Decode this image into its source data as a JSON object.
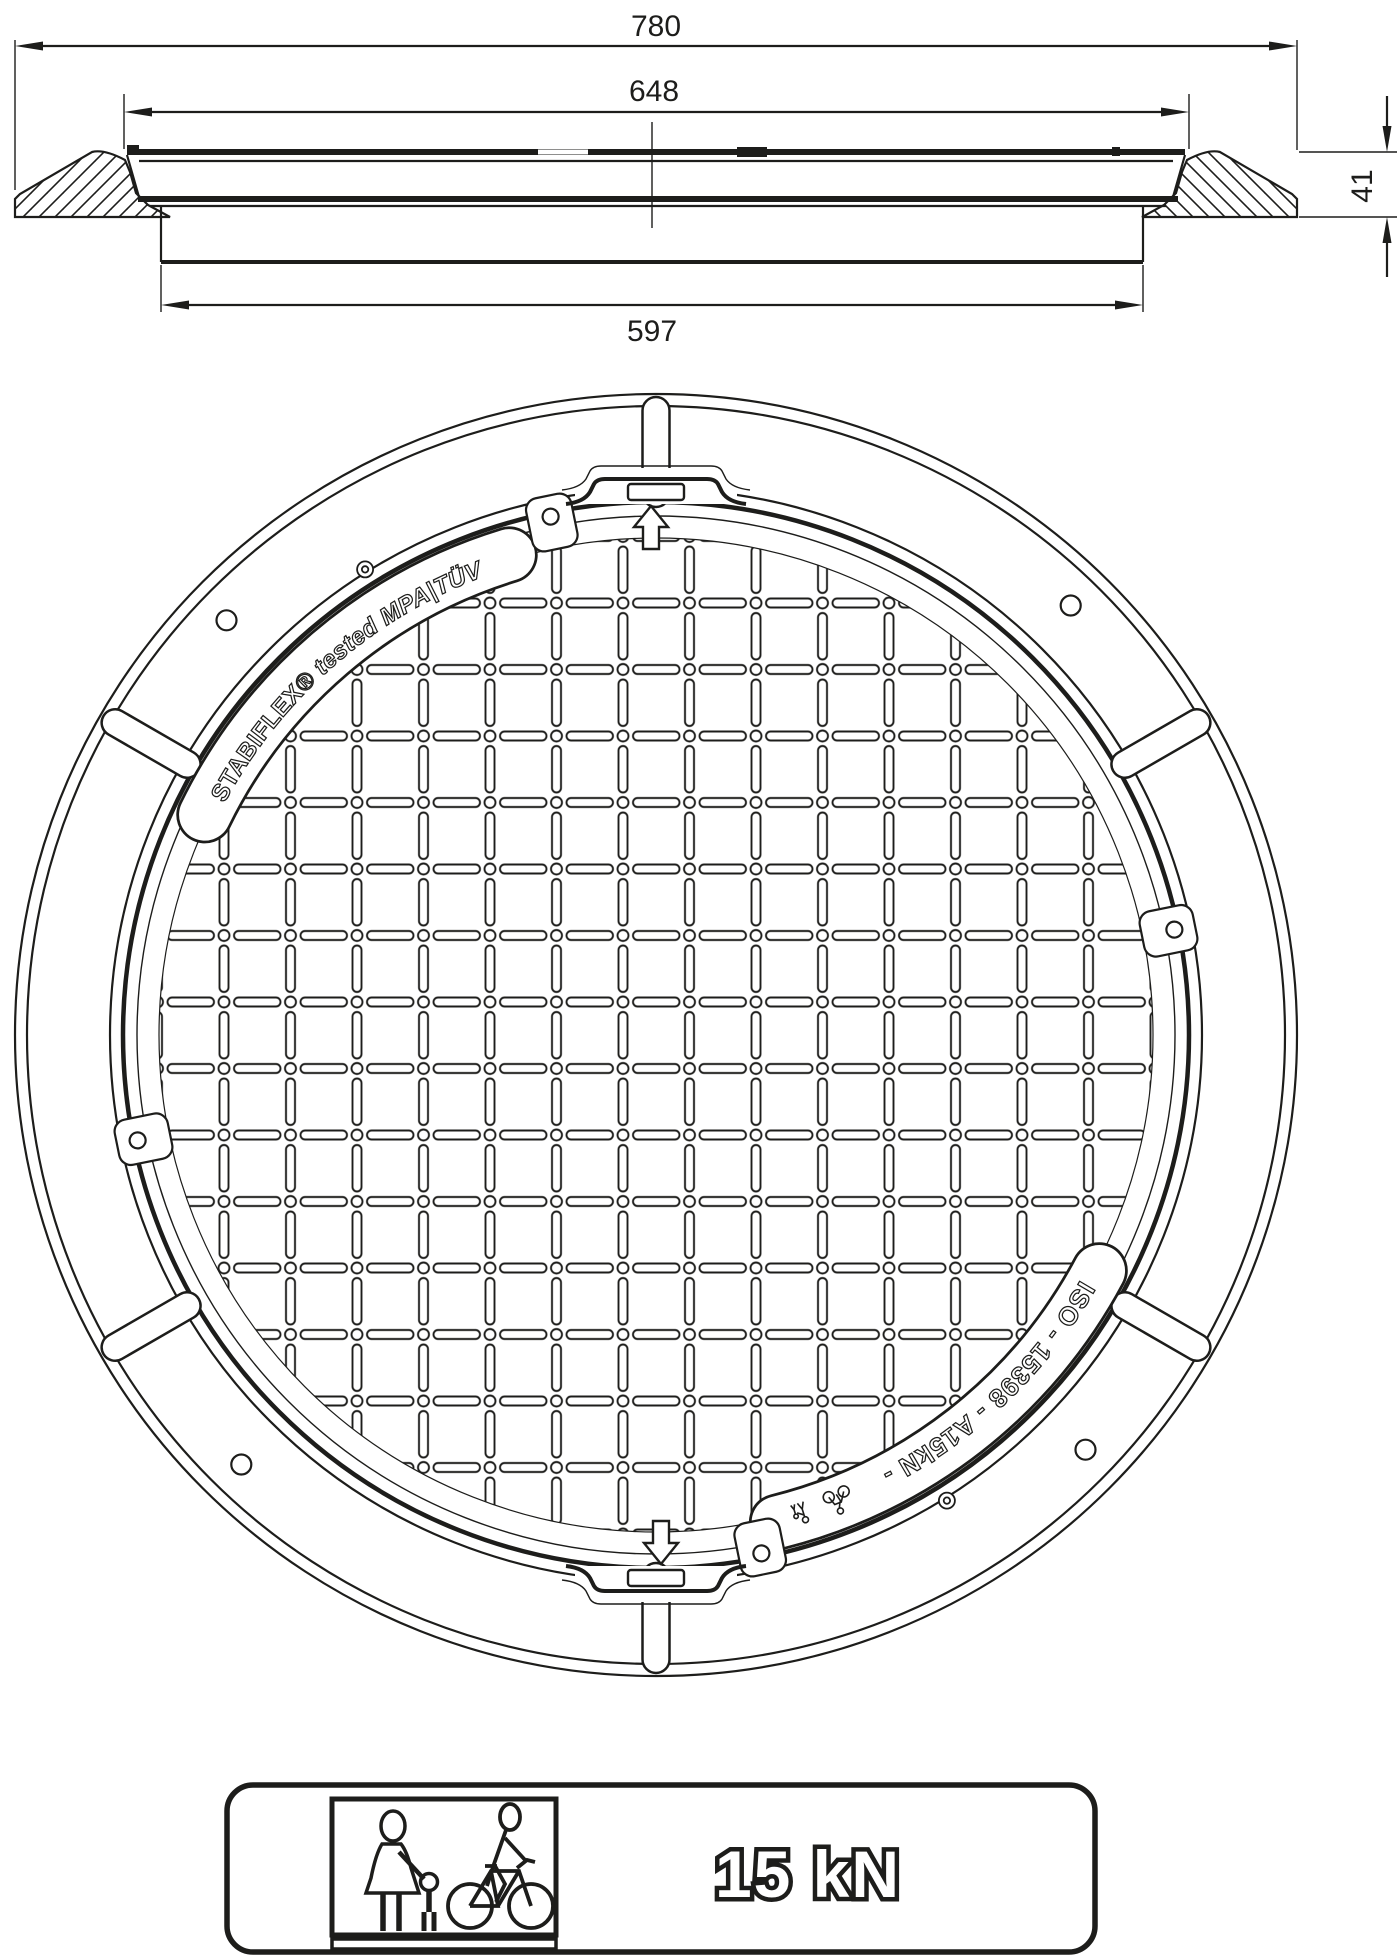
{
  "title": "STABIFLEX manhole cover technical drawing",
  "colors": {
    "line": "#1d1d1b",
    "background": "#ffffff"
  },
  "section_view": {
    "dim_overall_width": "780",
    "dim_cover_width": "648",
    "dim_skirt_width": "597",
    "dim_height": "41"
  },
  "plan_view": {
    "brand_text": "STABIFLEX®",
    "tested_text": "tested",
    "cert_text": "MPA|TÜV",
    "iso_text": "ISO - 15398 - A15kN -"
  },
  "load_label": {
    "value": "15 kN"
  }
}
